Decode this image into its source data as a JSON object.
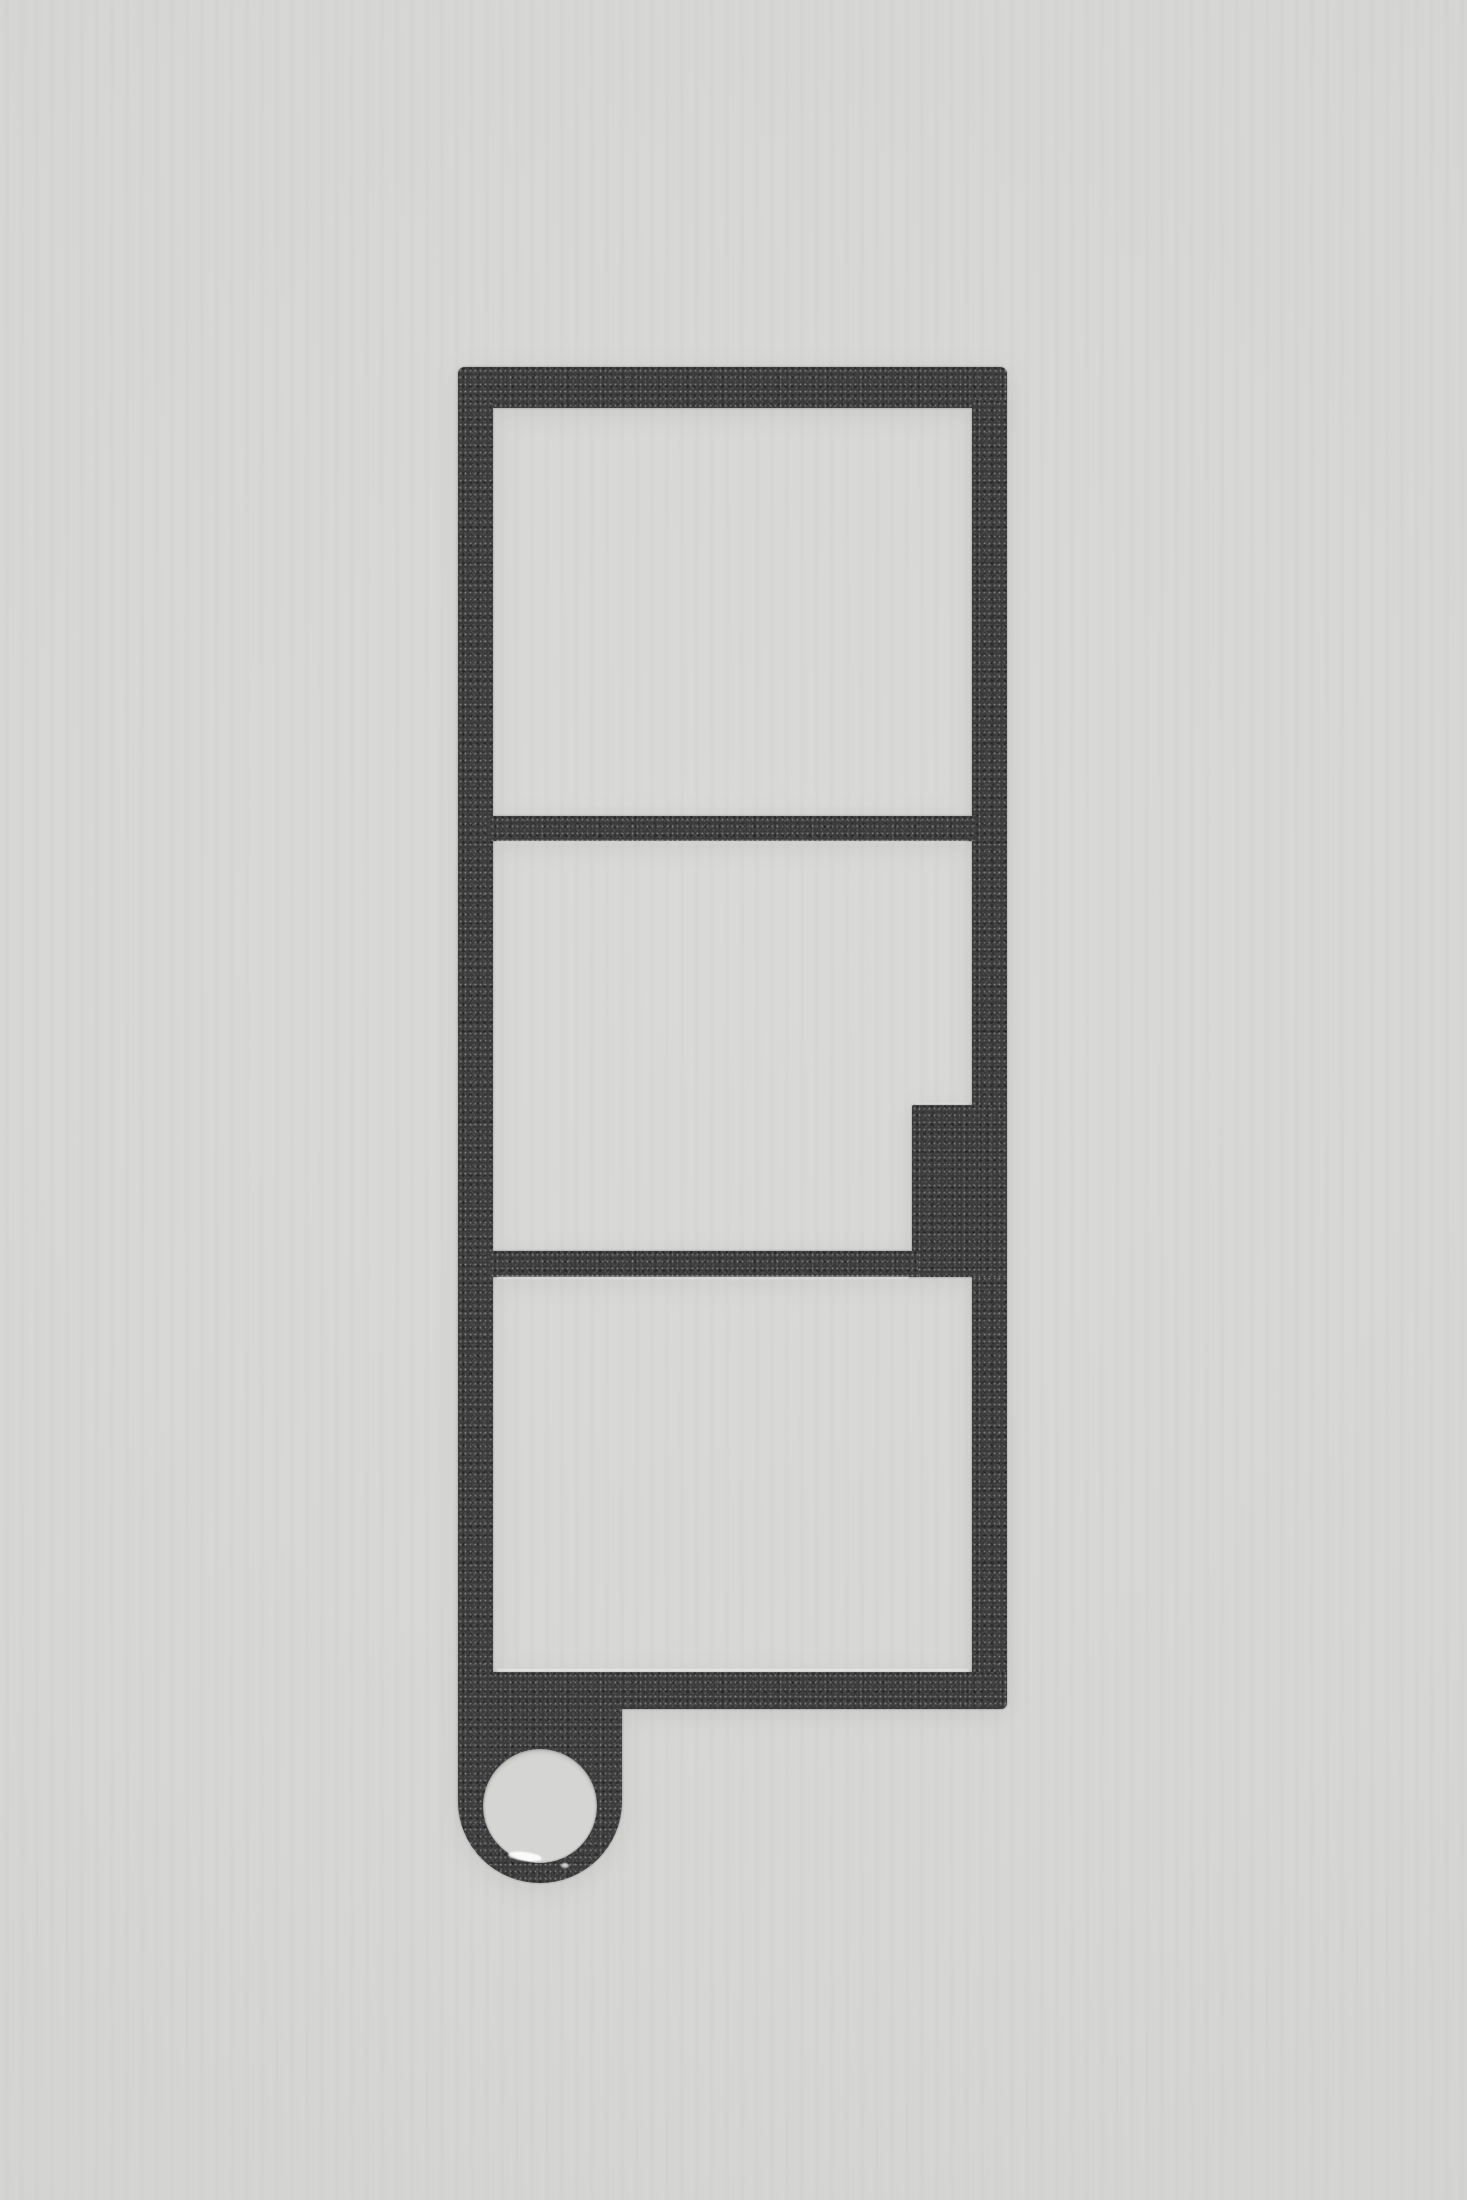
{
  "image": {
    "type": "product-photograph",
    "description": "Flat dark charcoal metal keychain plate with speckled powder-coat texture, shaped as a vertical frame with three rectangular cutout windows, a stepped notch on the right side of the middle window, and a bottom-left rounded tab with a circular keyring hole, photographed on a plain light gray background",
    "background_color": "#d5d5d3",
    "metal_base_color": "#3b3b3c",
    "speckle_color": "#c8ced8",
    "edge_glint_color": "#ffffff",
    "hole_rim_highlight_color": "#ffffff",
    "object": {
      "name": "three-window metal frame keychain plate",
      "orientation": "vertical",
      "window_count": 3,
      "features": [
        "rounded top outer corners",
        "top window",
        "middle window with right-side notch step",
        "bottom window",
        "full-width bottom bar",
        "rounded lanyard tab at bottom left",
        "circular keyring hole",
        "specular chips on lower hole rim",
        "light glint lines along cut edges"
      ],
      "hole_shape": "circle"
    }
  }
}
